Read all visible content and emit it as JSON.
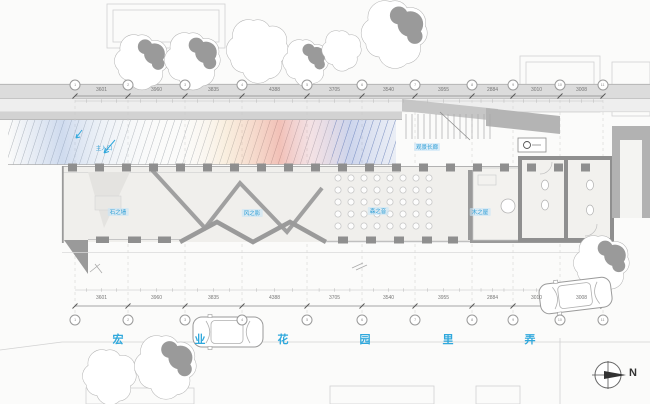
{
  "drawing": {
    "type": "architectural-site-plan",
    "north_label": "N"
  },
  "colors": {
    "annotation_blue": "#2fa8dc",
    "road_gray": "#dcdcdc",
    "wall_dark": "#8f8f8f",
    "wall_light": "#b5b5b5",
    "floor": "#f0efec",
    "tree_gray": "#9a9a9a",
    "hatch_warm": "#e2614a",
    "hatch_cool": "#6d86cf"
  },
  "grid": {
    "x": [
      75,
      128,
      185,
      242,
      307,
      362,
      415,
      472,
      513,
      560,
      603
    ],
    "top_labels": [
      "1",
      "2",
      "3",
      "4",
      "5",
      "6",
      "7",
      "8",
      "9",
      "10",
      "11"
    ],
    "bottom_labels": [
      "1",
      "2",
      "3",
      "4",
      "5",
      "6",
      "7",
      "8",
      "9",
      "10",
      "11"
    ]
  },
  "dimensions": {
    "top": [
      "3601",
      "3960",
      "3835",
      "4388",
      "3705",
      "3540",
      "3955",
      "2884",
      "3010",
      "3008"
    ],
    "bottom": [
      "3601",
      "3960",
      "3835",
      "4388",
      "3705",
      "3540",
      "3955",
      "2884",
      "3010",
      "3008"
    ]
  },
  "street": {
    "chars": [
      "宏",
      "业",
      "花",
      "园",
      "里",
      "弄"
    ],
    "char_x": [
      118,
      200,
      283,
      365,
      448,
      530
    ],
    "char_y": 331
  },
  "annotations": {
    "entrance": {
      "text": "主入口",
      "x": 104,
      "y": 148
    },
    "corridor": {
      "text": "观景长廊",
      "x": 427,
      "y": 147
    },
    "zones": [
      {
        "text": "石之墙",
        "x": 118,
        "y": 212
      },
      {
        "text": "风之影",
        "x": 252,
        "y": 213
      },
      {
        "text": "森之音",
        "x": 378,
        "y": 211
      },
      {
        "text": "木之屋",
        "x": 480,
        "y": 212
      }
    ]
  }
}
